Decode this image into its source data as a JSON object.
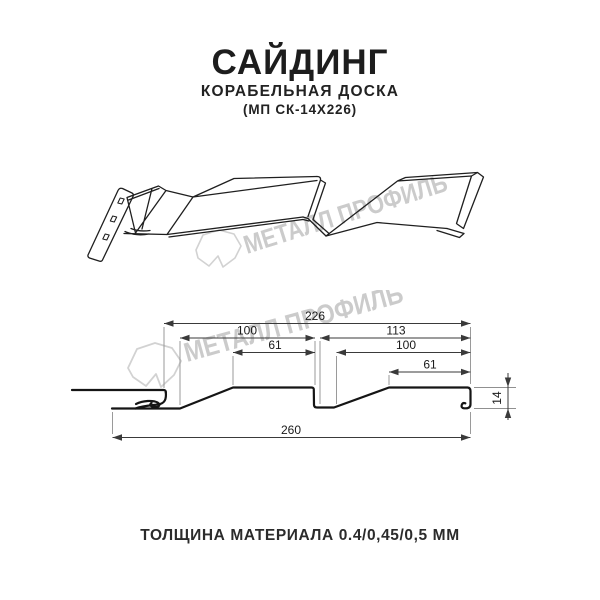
{
  "header": {
    "title": "САЙДИНГ",
    "subtitle": "КОРАБЕЛЬНАЯ ДОСКА",
    "model": "(МП СК-14Х226)"
  },
  "watermark": {
    "text": "МЕТАЛЛ ПРОФИЛЬ"
  },
  "dimensions": {
    "overall_width": "226",
    "left_board_width": "100",
    "right_board_width": "113",
    "left_flat": "61",
    "right_slope_width": "100",
    "right_flat": "61",
    "total_width": "260",
    "profile_height": "14"
  },
  "footer": {
    "thickness": "ТОЛЩИНА МАТЕРИАЛА 0.4/0,45/0,5 ММ"
  },
  "colors": {
    "line": "#1a1a1a",
    "dimension_line": "#3a3a3a",
    "extension_line": "#909090",
    "watermark": "#cbcbcb",
    "background": "#ffffff"
  }
}
